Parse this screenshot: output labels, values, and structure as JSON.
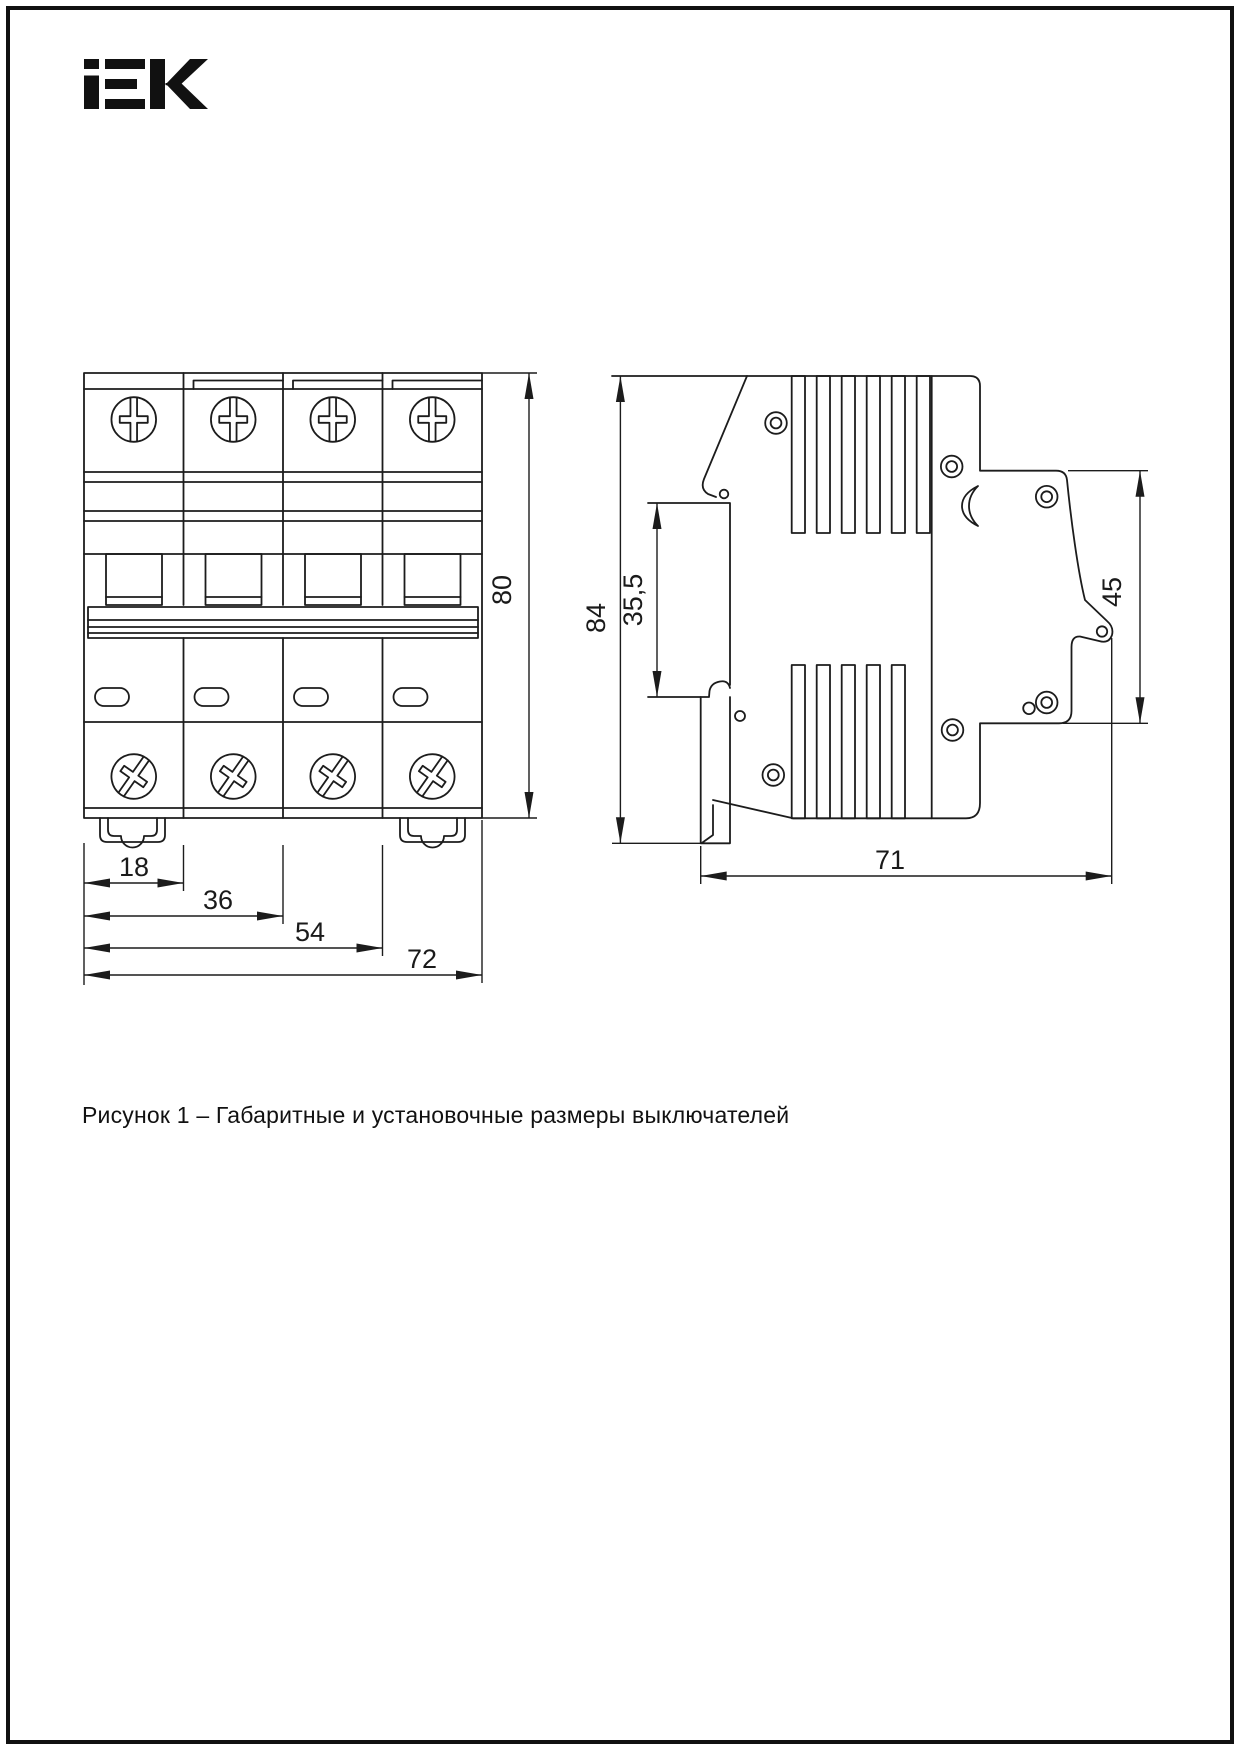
{
  "logo": {
    "alt": "IEK"
  },
  "figure": {
    "caption": "Рисунок 1 – Габаритные и установочные размеры выключателей"
  },
  "front_view": {
    "description": "front view of 4-pole circuit breaker",
    "dimensions": {
      "module_width": "18",
      "two_modules": "36",
      "three_modules": "54",
      "total_width": "72",
      "height": "80"
    }
  },
  "side_view": {
    "description": "side view of circuit breaker",
    "dimensions": {
      "total_height": "84",
      "din_seat": "35,5",
      "front_height": "45",
      "depth": "71"
    }
  },
  "colors": {
    "line": "#1c1c1c",
    "background": "#ffffff"
  }
}
